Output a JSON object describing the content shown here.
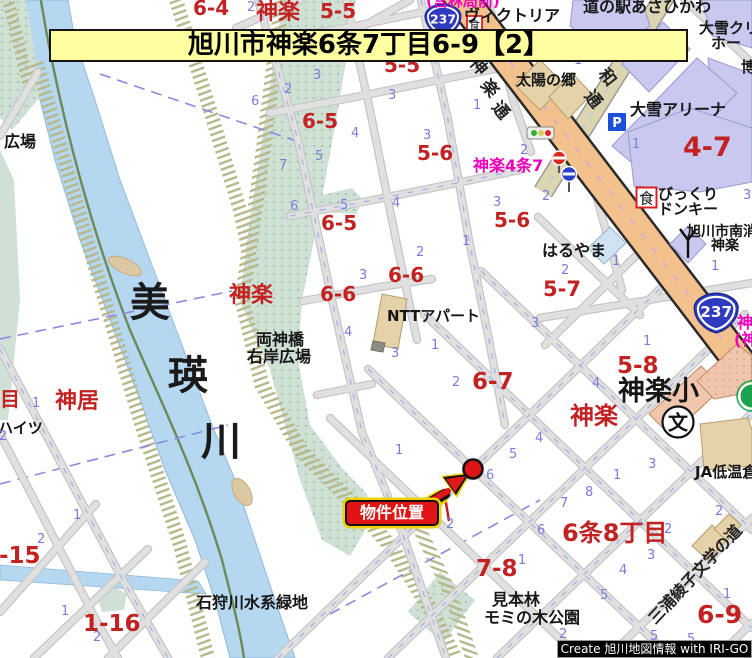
{
  "colors": {
    "banner_bg": "#ffffa0",
    "route_badge_blue": "#2f3bbf",
    "highway_orange": "#f3c18d",
    "secondary_road_khaki": "#dbd6b1",
    "river_blue": "#b5d7ef",
    "park_green": "#cfe0d4",
    "marker_red": "#e01414",
    "marker_glow_yellow": "#f0d000",
    "district_label_red": "#c22222",
    "busstop_label_pink": "#ee00bb",
    "block_number_purple": "#7b7bdc",
    "credit_bg": "#000000"
  },
  "banner": {
    "title": "旭川市神楽6条7丁目6-9【2】"
  },
  "credit": {
    "text": "Create 旭川地図情報 with IRI-GO"
  },
  "marker": {
    "label": "物件位置"
  },
  "routes": [
    "237",
    "237"
  ],
  "icons": {
    "parking": "P",
    "restaurant_a": "食",
    "restaurant_b": "食",
    "school": "文"
  },
  "labels": [
    {
      "t": "6-4",
      "x": 193,
      "y": -2,
      "k": "red",
      "s": 20
    },
    {
      "t": "神楽",
      "x": 256,
      "y": 2,
      "k": "red",
      "s": 22
    },
    {
      "t": "5-5",
      "x": 320,
      "y": 1,
      "k": "red",
      "s": 20
    },
    {
      "t": "5-5",
      "x": 384,
      "y": 55,
      "k": "red",
      "s": 20
    },
    {
      "t": "6-5",
      "x": 302,
      "y": 111,
      "k": "red",
      "s": 20
    },
    {
      "t": "5-6",
      "x": 417,
      "y": 143,
      "k": "red",
      "s": 20
    },
    {
      "t": "5-6",
      "x": 494,
      "y": 210,
      "k": "red",
      "s": 20
    },
    {
      "t": "6-5",
      "x": 321,
      "y": 213,
      "k": "red",
      "s": 20
    },
    {
      "t": "6-6",
      "x": 388,
      "y": 265,
      "k": "red",
      "s": 20
    },
    {
      "t": "6-6",
      "x": 320,
      "y": 284,
      "k": "red",
      "s": 20
    },
    {
      "t": "5-7",
      "x": 543,
      "y": 279,
      "k": "red",
      "s": 21
    },
    {
      "t": "6-7",
      "x": 472,
      "y": 371,
      "k": "red",
      "s": 23
    },
    {
      "t": "5-8",
      "x": 617,
      "y": 355,
      "k": "red",
      "s": 23
    },
    {
      "t": "4-7",
      "x": 683,
      "y": 134,
      "k": "red",
      "s": 27
    },
    {
      "t": "7-8",
      "x": 476,
      "y": 558,
      "k": "red",
      "s": 23
    },
    {
      "t": "6条8丁目",
      "x": 562,
      "y": 521,
      "k": "red",
      "s": 24
    },
    {
      "t": "6-9",
      "x": 697,
      "y": 602,
      "k": "red",
      "s": 25
    },
    {
      "t": "1-16",
      "x": 83,
      "y": 613,
      "k": "red",
      "s": 23
    },
    {
      "t": "1-15",
      "x": -17,
      "y": 545,
      "k": "red",
      "s": 23
    },
    {
      "t": "目",
      "x": 0,
      "y": 389,
      "k": "red",
      "s": 20
    },
    {
      "t": "神居",
      "x": 55,
      "y": 391,
      "k": "red",
      "s": 22
    },
    {
      "t": "神楽",
      "x": 229,
      "y": 285,
      "k": "red",
      "s": 22
    },
    {
      "t": "神楽",
      "x": 570,
      "y": 404,
      "k": "red",
      "s": 24
    },
    {
      "t": "神楽4条7",
      "x": 473,
      "y": 158,
      "k": "pink",
      "s": 16
    },
    {
      "t": "(営林局前)",
      "x": 426,
      "y": -6,
      "k": "pink",
      "s": 15
    },
    {
      "t": "神",
      "x": 737,
      "y": 315,
      "k": "pink",
      "s": 16
    },
    {
      "t": "(神",
      "x": 734,
      "y": 332,
      "k": "pink",
      "s": 16
    },
    {
      "t": "ヴィクトリア",
      "x": 464,
      "y": 8,
      "k": "place",
      "s": 16
    },
    {
      "t": "道の駅あさひかわ",
      "x": 583,
      "y": -1,
      "k": "place",
      "s": 16
    },
    {
      "t": "大雪クリ",
      "x": 699,
      "y": 21,
      "k": "place",
      "s": 15
    },
    {
      "t": "ホー",
      "x": 711,
      "y": 36,
      "k": "place",
      "s": 15
    },
    {
      "t": "博",
      "x": 741,
      "y": 60,
      "k": "place",
      "s": 15
    },
    {
      "t": "大雪アリーナ",
      "x": 630,
      "y": 102,
      "k": "place",
      "s": 16
    },
    {
      "t": "太陽の郷",
      "x": 516,
      "y": 73,
      "k": "place",
      "s": 15
    },
    {
      "t": "はるやま",
      "x": 542,
      "y": 243,
      "k": "place",
      "s": 16
    },
    {
      "t": "びっくり",
      "x": 658,
      "y": 187,
      "k": "place",
      "s": 15
    },
    {
      "t": "ドンキー",
      "x": 658,
      "y": 202,
      "k": "place",
      "s": 15
    },
    {
      "t": "旭川市南消",
      "x": 687,
      "y": 225,
      "k": "place",
      "s": 14
    },
    {
      "t": "神楽",
      "x": 711,
      "y": 239,
      "k": "place",
      "s": 14
    },
    {
      "t": "NTTアパート",
      "x": 387,
      "y": 309,
      "k": "place",
      "s": 15
    },
    {
      "t": "両神橋",
      "x": 256,
      "y": 332,
      "k": "place",
      "s": 16
    },
    {
      "t": "右岸広場",
      "x": 247,
      "y": 349,
      "k": "place",
      "s": 16
    },
    {
      "t": "広場",
      "x": 4,
      "y": 134,
      "k": "place",
      "s": 16
    },
    {
      "t": "ハイツ",
      "x": -2,
      "y": 421,
      "k": "place",
      "s": 15
    },
    {
      "t": "神楽小",
      "x": 618,
      "y": 378,
      "k": "place",
      "s": 27
    },
    {
      "t": "JA低温倉庫",
      "x": 695,
      "y": 465,
      "k": "place",
      "s": 15
    },
    {
      "t": "石狩川水系緑地",
      "x": 196,
      "y": 595,
      "k": "place",
      "s": 16
    },
    {
      "t": "見本林",
      "x": 492,
      "y": 592,
      "k": "place",
      "s": 16
    },
    {
      "t": "モミの木公園",
      "x": 484,
      "y": 610,
      "k": "place",
      "s": 16
    },
    {
      "t": "美",
      "x": 130,
      "y": 283,
      "k": "river",
      "s": 40
    },
    {
      "t": "瑛",
      "x": 168,
      "y": 356,
      "k": "river",
      "s": 40
    },
    {
      "t": "川",
      "x": 201,
      "y": 422,
      "k": "river",
      "s": 40
    },
    {
      "t": "三浦綾子文学の道",
      "x": 646,
      "y": 616,
      "k": "road",
      "s": 16,
      "r": -47
    },
    {
      "t": "神",
      "x": 479,
      "y": 55,
      "k": "road",
      "s": 17,
      "r": 50
    },
    {
      "t": "楽",
      "x": 490,
      "y": 77,
      "k": "road",
      "s": 17,
      "r": 50
    },
    {
      "t": "通",
      "x": 501,
      "y": 99,
      "k": "road",
      "s": 17,
      "r": 50
    },
    {
      "t": "和",
      "x": 608,
      "y": 66,
      "k": "road",
      "s": 17,
      "r": 52
    },
    {
      "t": "通",
      "x": 594,
      "y": 88,
      "k": "road",
      "s": 17,
      "r": 52
    },
    {
      "t": "2",
      "x": 247,
      "y": 1,
      "k": "num",
      "s": 13
    },
    {
      "t": "3",
      "x": 313,
      "y": 69,
      "k": "num",
      "s": 13
    },
    {
      "t": "2",
      "x": 284,
      "y": 83,
      "k": "num",
      "s": 13
    },
    {
      "t": "6",
      "x": 251,
      "y": 95,
      "k": "num",
      "s": 13
    },
    {
      "t": "3",
      "x": 388,
      "y": 89,
      "k": "num",
      "s": 13
    },
    {
      "t": "1",
      "x": 473,
      "y": 99,
      "k": "num",
      "s": 13
    },
    {
      "t": "4",
      "x": 351,
      "y": 127,
      "k": "num",
      "s": 13
    },
    {
      "t": "3",
      "x": 423,
      "y": 129,
      "k": "num",
      "s": 13
    },
    {
      "t": "5",
      "x": 315,
      "y": 150,
      "k": "num",
      "s": 13
    },
    {
      "t": "7",
      "x": 279,
      "y": 159,
      "k": "num",
      "s": 13
    },
    {
      "t": "2",
      "x": 520,
      "y": 144,
      "k": "num",
      "s": 13
    },
    {
      "t": "1",
      "x": 632,
      "y": 138,
      "k": "num",
      "s": 13
    },
    {
      "t": "1",
      "x": 574,
      "y": 54,
      "k": "num",
      "s": 13
    },
    {
      "t": "6",
      "x": 290,
      "y": 200,
      "k": "num",
      "s": 13
    },
    {
      "t": "5",
      "x": 340,
      "y": 199,
      "k": "num",
      "s": 13
    },
    {
      "t": "4",
      "x": 392,
      "y": 197,
      "k": "num",
      "s": 13
    },
    {
      "t": "3",
      "x": 493,
      "y": 196,
      "k": "num",
      "s": 13
    },
    {
      "t": "2",
      "x": 542,
      "y": 190,
      "k": "num",
      "s": 13
    },
    {
      "t": "1",
      "x": 462,
      "y": 235,
      "k": "num",
      "s": 13
    },
    {
      "t": "2",
      "x": 416,
      "y": 246,
      "k": "num",
      "s": 13
    },
    {
      "t": "1",
      "x": 612,
      "y": 255,
      "k": "num",
      "s": 13
    },
    {
      "t": "2",
      "x": 561,
      "y": 264,
      "k": "num",
      "s": 13
    },
    {
      "t": "1",
      "x": 711,
      "y": 260,
      "k": "num",
      "s": 13
    },
    {
      "t": "3",
      "x": 359,
      "y": 269,
      "k": "num",
      "s": 13
    },
    {
      "t": "3",
      "x": 531,
      "y": 317,
      "k": "num",
      "s": 13
    },
    {
      "t": "1",
      "x": 643,
      "y": 335,
      "k": "num",
      "s": 13
    },
    {
      "t": "4",
      "x": 344,
      "y": 326,
      "k": "num",
      "s": 13
    },
    {
      "t": "3",
      "x": 391,
      "y": 347,
      "k": "num",
      "s": 13
    },
    {
      "t": "1",
      "x": 431,
      "y": 339,
      "k": "num",
      "s": 13
    },
    {
      "t": "2",
      "x": 452,
      "y": 376,
      "k": "num",
      "s": 13
    },
    {
      "t": "4",
      "x": 592,
      "y": 377,
      "k": "num",
      "s": 13
    },
    {
      "t": "3",
      "x": 743,
      "y": 189,
      "k": "num",
      "s": 13
    },
    {
      "t": "1",
      "x": 395,
      "y": 444,
      "k": "num",
      "s": 13
    },
    {
      "t": "5",
      "x": 509,
      "y": 448,
      "k": "num",
      "s": 13
    },
    {
      "t": "4",
      "x": 535,
      "y": 432,
      "k": "num",
      "s": 13
    },
    {
      "t": "6",
      "x": 486,
      "y": 469,
      "k": "num",
      "s": 13
    },
    {
      "t": "1",
      "x": 613,
      "y": 469,
      "k": "num",
      "s": 13
    },
    {
      "t": "3",
      "x": 648,
      "y": 458,
      "k": "num",
      "s": 13
    },
    {
      "t": "8",
      "x": 585,
      "y": 486,
      "k": "num",
      "s": 13
    },
    {
      "t": "7",
      "x": 560,
      "y": 497,
      "k": "num",
      "s": 13
    },
    {
      "t": "2",
      "x": 446,
      "y": 518,
      "k": "num",
      "s": 13
    },
    {
      "t": "6",
      "x": 537,
      "y": 524,
      "k": "num",
      "s": 13
    },
    {
      "t": "2",
      "x": 664,
      "y": 523,
      "k": "num",
      "s": 13
    },
    {
      "t": "2",
      "x": 715,
      "y": 505,
      "k": "num",
      "s": 13
    },
    {
      "t": "3",
      "x": 647,
      "y": 549,
      "k": "num",
      "s": 13
    },
    {
      "t": "4",
      "x": 619,
      "y": 564,
      "k": "num",
      "s": 13
    },
    {
      "t": "1",
      "x": 518,
      "y": 554,
      "k": "num",
      "s": 13
    },
    {
      "t": "5",
      "x": 600,
      "y": 589,
      "k": "num",
      "s": 13
    },
    {
      "t": "1",
      "x": 723,
      "y": 588,
      "k": "num",
      "s": 13
    },
    {
      "t": "2",
      "x": 559,
      "y": 628,
      "k": "num",
      "s": 13
    },
    {
      "t": "5",
      "x": 650,
      "y": 630,
      "k": "num",
      "s": 13
    },
    {
      "t": "5",
      "x": 687,
      "y": 633,
      "k": "num",
      "s": 13
    },
    {
      "t": "1",
      "x": 32,
      "y": 397,
      "k": "num",
      "s": 13
    },
    {
      "t": "2",
      "x": -1,
      "y": 430,
      "k": "num",
      "s": 13
    },
    {
      "t": "1",
      "x": 73,
      "y": 509,
      "k": "num",
      "s": 13
    },
    {
      "t": "2",
      "x": 37,
      "y": 533,
      "k": "num",
      "s": 13
    },
    {
      "t": "1",
      "x": 61,
      "y": 605,
      "k": "num",
      "s": 13
    },
    {
      "t": "2",
      "x": 93,
      "y": 631,
      "k": "num",
      "s": 13
    }
  ]
}
